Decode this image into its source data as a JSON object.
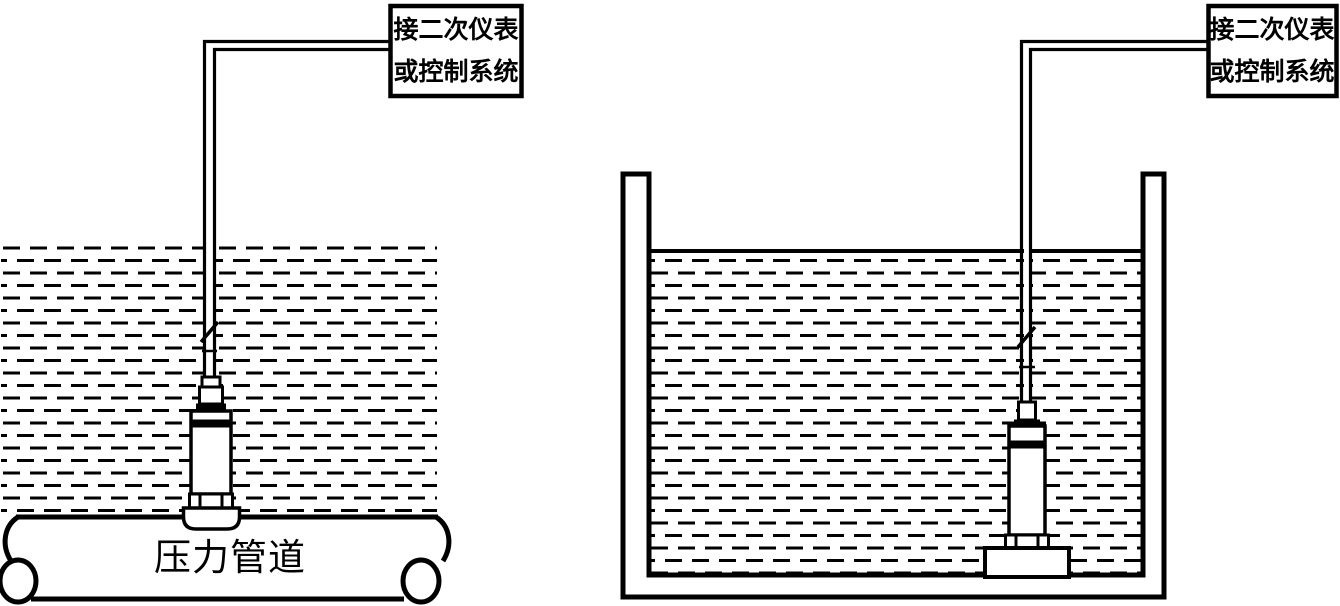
{
  "canvas": {
    "background": "#ffffff",
    "line_color": "#000000"
  },
  "left_diagram": {
    "connect_box": {
      "line1": "接二次仪表",
      "line2": "或控制系统"
    },
    "pipe_label": "压力管道"
  },
  "right_diagram": {
    "connect_box": {
      "line1": "接二次仪表",
      "line2": "或控制系统"
    }
  }
}
